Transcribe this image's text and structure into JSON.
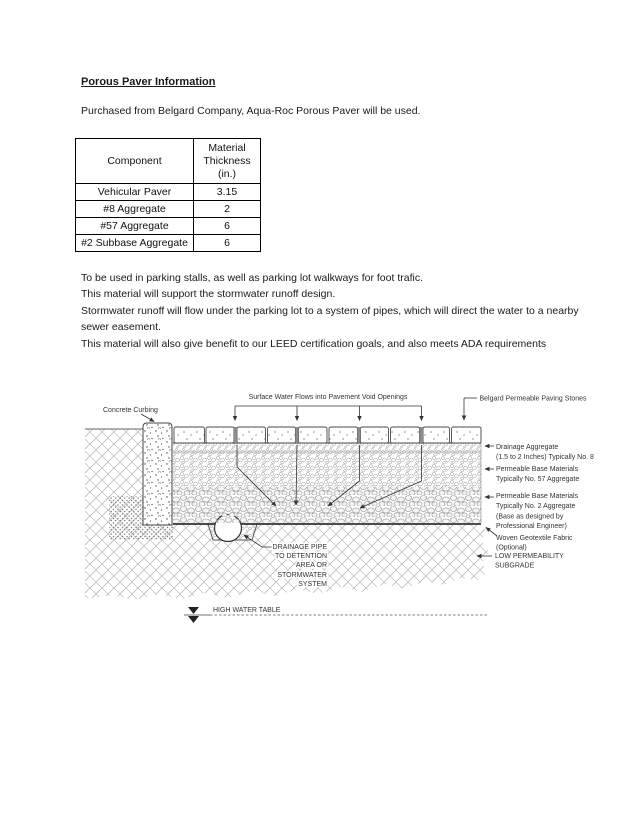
{
  "doc": {
    "title": "Porous Paver Information",
    "intro": "Purchased from Belgard Company, Aqua-Roc Porous Paver will be used.",
    "notes": [
      "To be used in parking stalls, as well as parking lot walkways for foot trafic.",
      "This material will support the stormwater runoff design.",
      "Stormwater runoff will flow under the parking lot to a system of pipes, which will direct the water to a nearby",
      "sewer easement.",
      "This material will also give benefit to our LEED certification goals, and also meets ADA requirements"
    ]
  },
  "table": {
    "col1_header": "Component",
    "col2_header": "Material Thickness (in.)",
    "rows": [
      {
        "component": "Vehicular Paver",
        "thickness": "3.15"
      },
      {
        "component": "#8 Aggregate",
        "thickness": "2"
      },
      {
        "component": "#57 Aggregate",
        "thickness": "6"
      },
      {
        "component": "#2 Subbase Aggregate",
        "thickness": "6"
      }
    ]
  },
  "diagram": {
    "surface_water_label": "Surface Water Flows into Pavement Void Openings",
    "concrete_curbing_label": "Concrete Curbing",
    "paving_stones_label": "Belgard Permeable Paving Stones",
    "drainage_aggregate_label": [
      "Drainage Aggregate",
      "(1.5 to 2 Inches) Typically No. 8"
    ],
    "base_57_label": [
      "Permeable Base Materials",
      "Typically No. 57 Aggregate"
    ],
    "base_2_label": [
      "Permeable Base Materials",
      "Typically No. 2 Aggregate",
      "(Base as designed by",
      "Professional Engineer)"
    ],
    "geotextile_label": [
      "Woven Geotextile Fabric",
      "(Optional)"
    ],
    "subgrade_label": [
      "LOW PERMEABILITY",
      "SUBGRADE"
    ],
    "drainage_pipe_label": [
      "DRAINAGE PIPE",
      "TO DETENTION",
      "AREA OR",
      "STORMWATER",
      "SYSTEM"
    ],
    "high_water_table_label": "HIGH WATER TABLE"
  }
}
